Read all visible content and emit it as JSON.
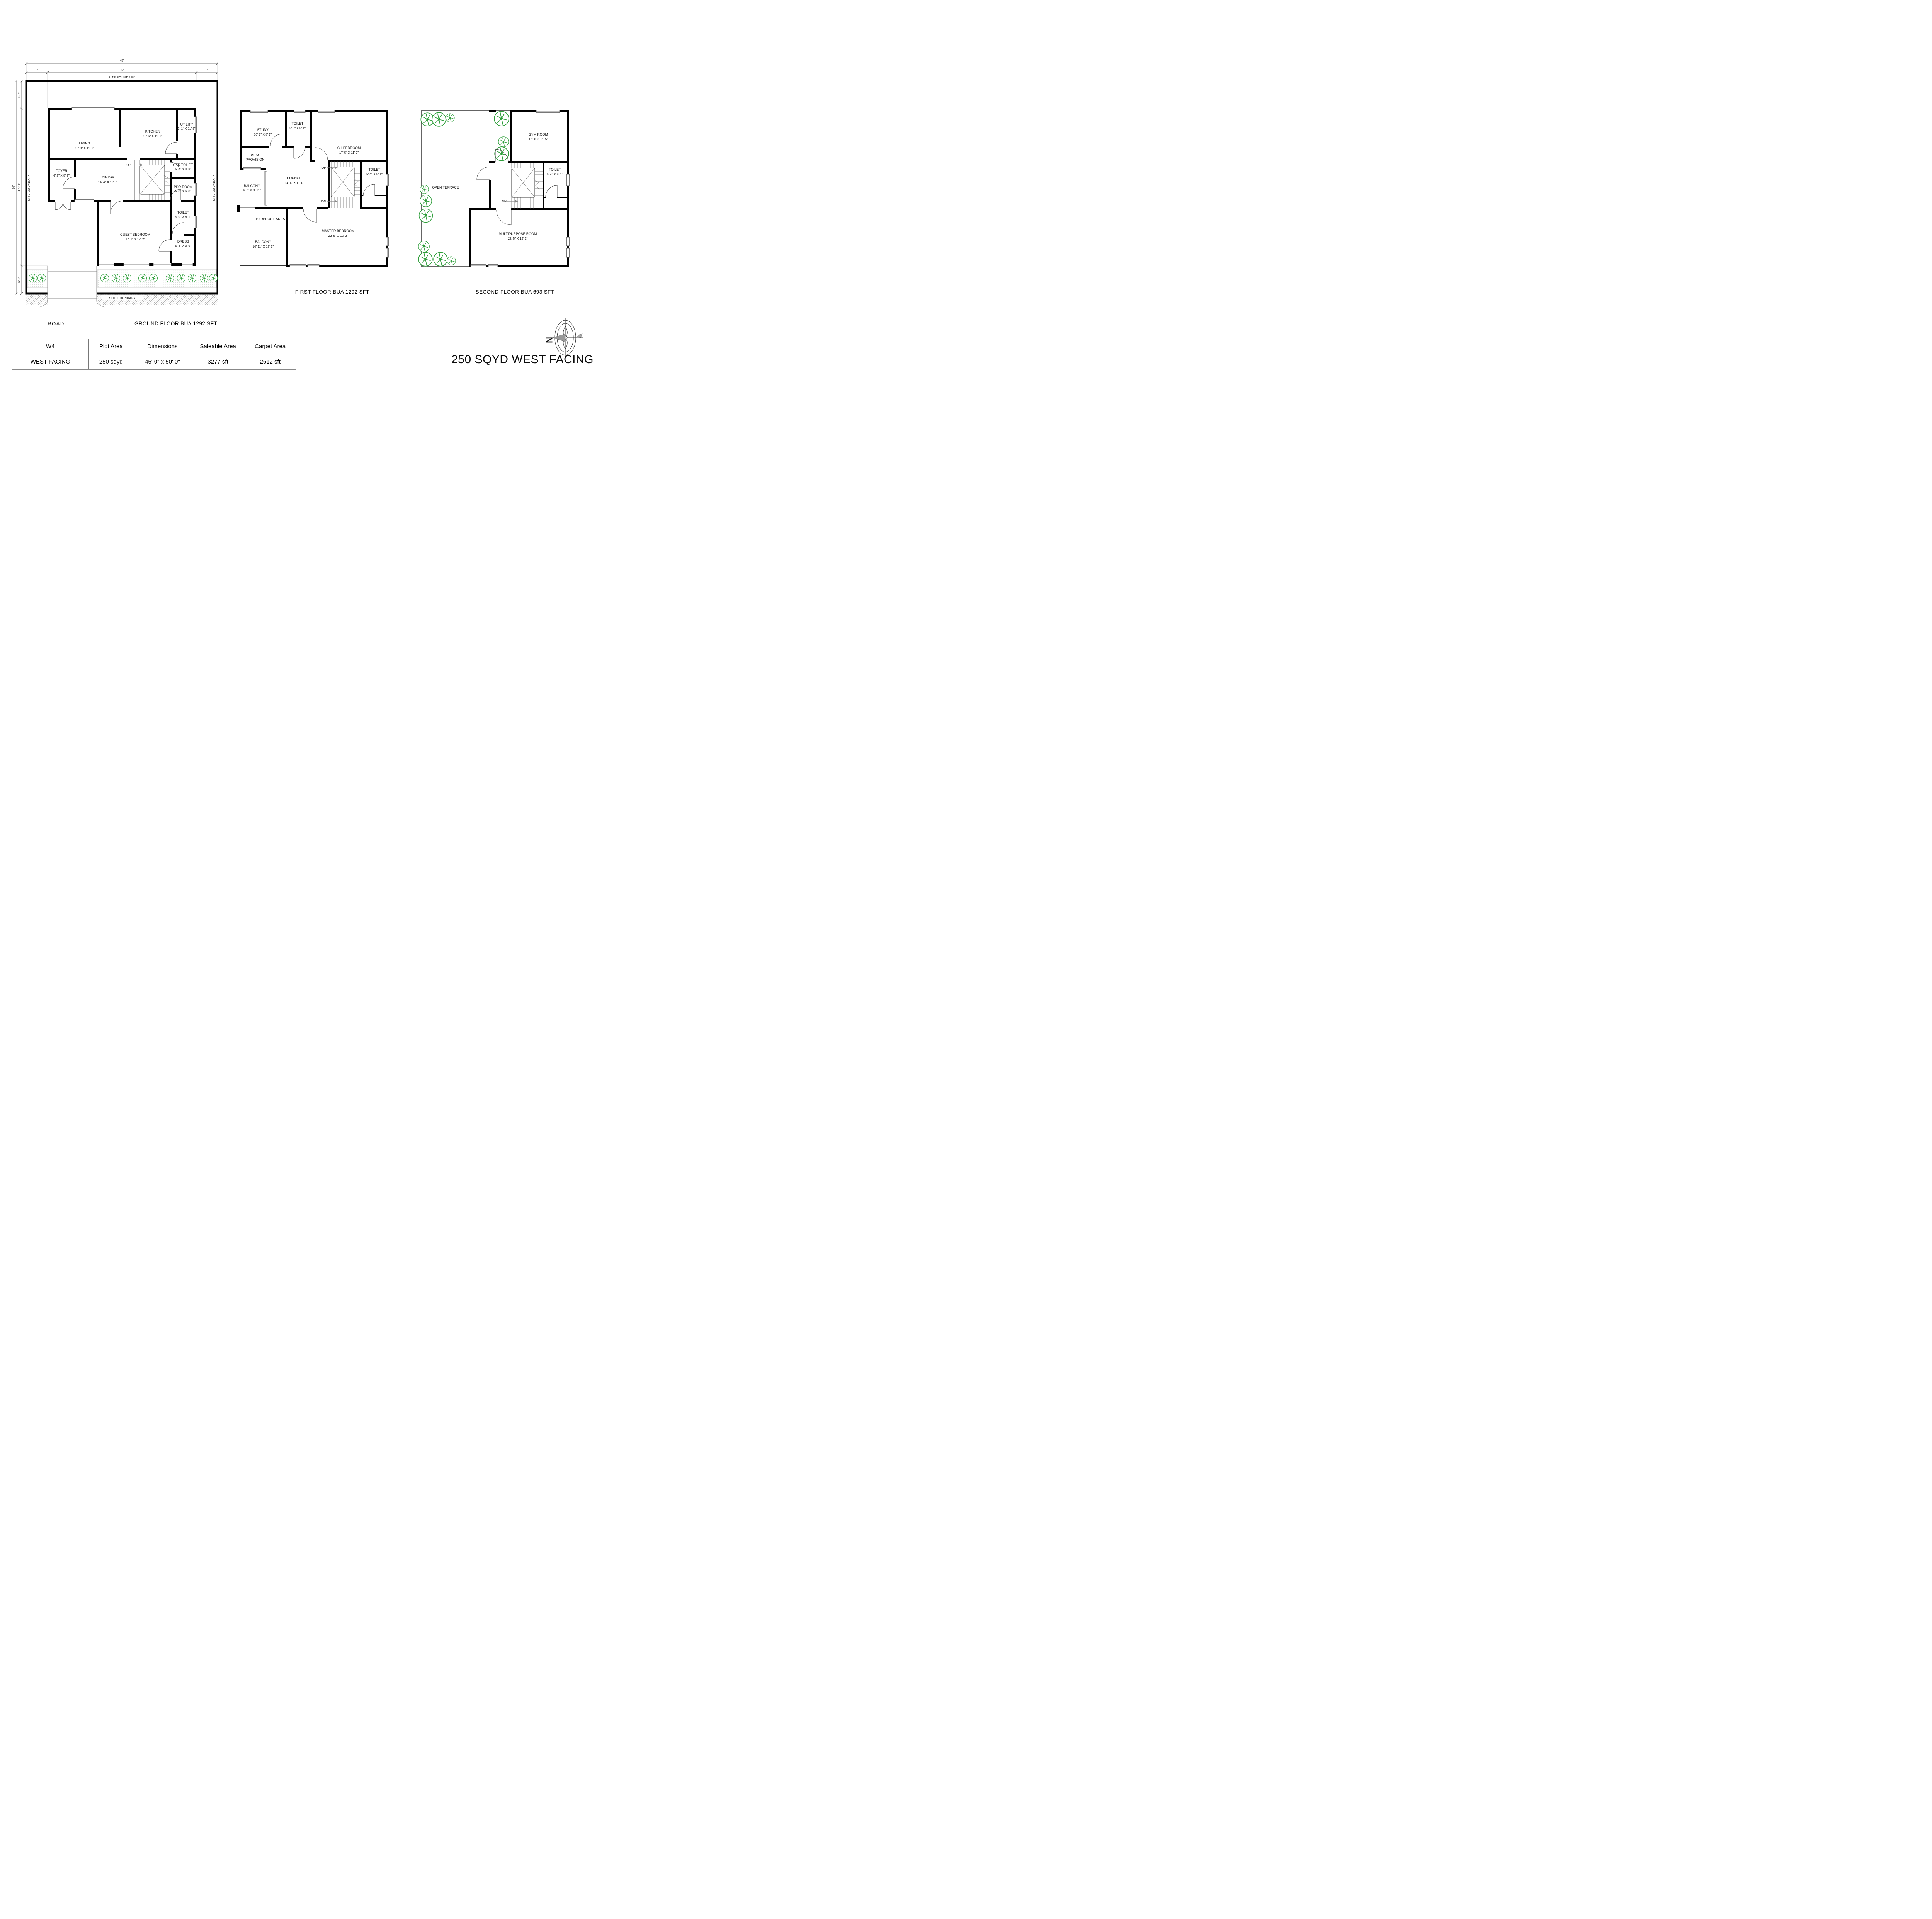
{
  "title": "250 SQYD WEST FACING",
  "compass": {
    "north_label": "N"
  },
  "site": {
    "boundary_label": "SITE BOUNDARY",
    "road_label": "ROAD"
  },
  "dimensions": {
    "total_width": "45'",
    "left_setback": "5'",
    "building_width": "35'",
    "right_setback": "5'",
    "total_height": "50'",
    "top_setback": "6'-7\"",
    "building_height": "36'-11\"",
    "bottom_setback": "6'-6\""
  },
  "floors": {
    "ground": {
      "caption": "GROUND FLOOR BUA 1292 SFT",
      "stairs_up": "UP",
      "rooms": {
        "living": {
          "name": "LIVING",
          "dims": "16' 9\" X 11' 9\""
        },
        "kitchen": {
          "name": "KITCHEN",
          "dims": "13' 6\" X 11' 9\""
        },
        "utility": {
          "name": "UTILITY",
          "dims": "3' 1\" X 11' 5\""
        },
        "foyer": {
          "name": "FOYER",
          "dims": "6' 2\" X 8' 9\""
        },
        "dining": {
          "name": "DINING",
          "dims": "14' 4\" X 11' 0\""
        },
        "ser_toilet": {
          "name": "SER TOILET",
          "dims": "5' 0\" X 4' 8\""
        },
        "pdr": {
          "name": "PDR ROOM",
          "dims": "5' 0\" X 6' 0\""
        },
        "toilet": {
          "name": "TOILET",
          "dims": "5' 0\" X 8' 1\""
        },
        "dress": {
          "name": "DRESS",
          "dims": "5' 4\" X 3' 9\""
        },
        "guest": {
          "name": "GUEST BEDROOM",
          "dims": "17' 1\" X 12' 2\""
        }
      }
    },
    "first": {
      "caption": "FIRST FLOOR BUA 1292 SFT",
      "stairs_up": "UP",
      "stairs_dn": "DN",
      "rooms": {
        "study": {
          "name": "STUDY",
          "dims": "10' 7\" X 8' 1\""
        },
        "toilet_top": {
          "name": "TOILET",
          "dims": "5' 0\" X 8' 1\""
        },
        "ch_bedroom": {
          "name": "CH BEDROOM",
          "dims": "17' 5\" X 11' 9\""
        },
        "puja": {
          "line1": "PUJA",
          "line2": "PROVISION"
        },
        "balcony_side": {
          "name": "BALCONY",
          "dims": "6' 2\"  X 9' 11\""
        },
        "lounge": {
          "name": "LOUNGE",
          "dims": "14' 4\" X 11' 0\""
        },
        "toilet_right": {
          "name": "TOILET",
          "dims": "5' 4\" X 8' 1\""
        },
        "barbeque": {
          "name": "BARBEQUE AREA"
        },
        "balcony_bottom": {
          "name": "BALCONY",
          "dims": "10' 11\"  X 12' 2\""
        },
        "master": {
          "name": "MASTER BEDROOM",
          "dims": "22' 5\" X 12' 2\""
        }
      }
    },
    "second": {
      "caption": "SECOND FLOOR BUA 693 SFT",
      "stairs_dn": "DN",
      "rooms": {
        "gym": {
          "name": "GYM ROOM",
          "dims": "12' 4\"  X 11' 5\""
        },
        "toilet": {
          "name": "TOILET",
          "dims": "5' 4\" X 8' 1\""
        },
        "terrace": {
          "name": "OPEN TERRACE"
        },
        "multipurpose": {
          "name": "MULTIPURPOSE ROOM",
          "dims": "22' 5\" X 12' 2\""
        }
      }
    }
  },
  "table": {
    "headers": [
      "W4",
      "Plot Area",
      "Dimensions",
      "Saleable Area",
      "Carpet Area"
    ],
    "row": [
      "WEST FACING",
      "250 sqyd",
      "45' 0\" x 50' 0\"",
      "3277 sft",
      "2612 sft"
    ]
  }
}
